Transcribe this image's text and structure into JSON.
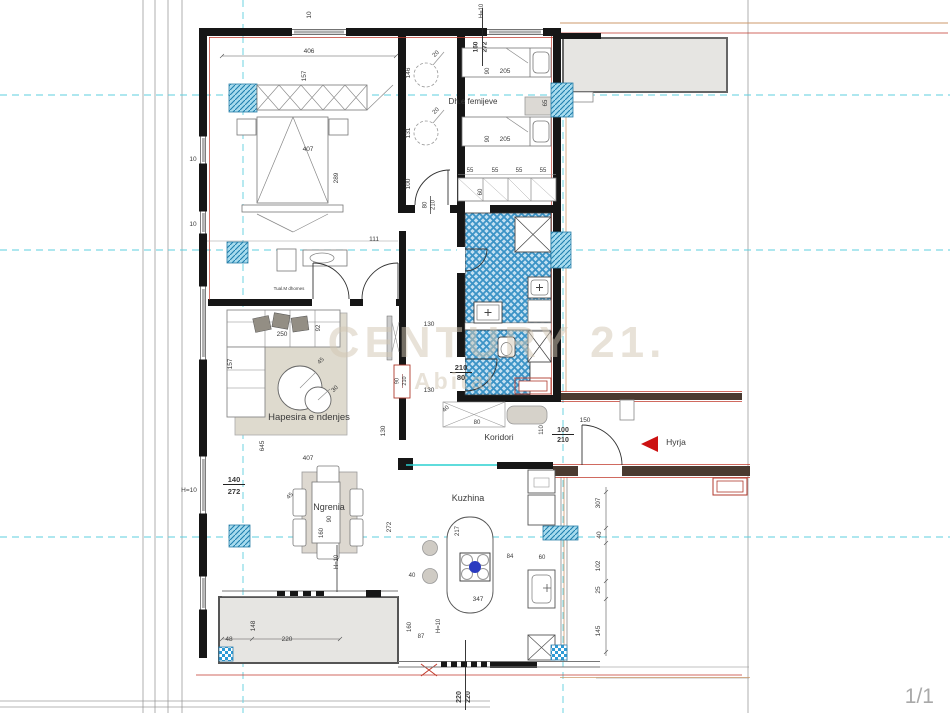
{
  "watermark": {
    "line1": "CENTURY 21.",
    "line2": "Abital"
  },
  "page": {
    "indicator": "1/1"
  },
  "colors": {
    "wall": "#161616",
    "accent_red": "#c0392b",
    "accent_orange": "#cd9a6b",
    "grid_cyan": "#5ecfdf",
    "tile_blue": "#3b93c6",
    "hatch_blue": "#1f7fae",
    "balcony_gray": "#e6e5e2",
    "watermark": "#d3c7b3"
  },
  "rooms": [
    {
      "t": "Dh.e femijeve",
      "x": 473,
      "y": 104,
      "s": 8
    },
    {
      "t": "Hapesira e ndenjes",
      "x": 309,
      "y": 420,
      "s": 9.5
    },
    {
      "t": "Ngrenia",
      "x": 329,
      "y": 510,
      "s": 9
    },
    {
      "t": "Kuzhina",
      "x": 468,
      "y": 501,
      "s": 9
    },
    {
      "t": "Koridori",
      "x": 499,
      "y": 440,
      "s": 8.5
    },
    {
      "t": "Hyrja",
      "x": 676,
      "y": 445,
      "s": 8.5
    },
    {
      "t": "Tual.M   dhomes",
      "x": 289,
      "y": 290,
      "s": 4.5
    }
  ],
  "annotations": [
    {
      "t": "10",
      "x": 311,
      "y": 15,
      "r": -90
    },
    {
      "t": "H=10",
      "x": 483,
      "y": 11,
      "r": -90,
      "c": "#c0392b",
      "s": 6
    },
    {
      "t": "160",
      "x": 477.5,
      "y": 47,
      "r": -90,
      "b": 1
    },
    {
      "t": "272",
      "x": 486.5,
      "y": 47,
      "r": -90,
      "b": 1
    },
    {
      "t": "10",
      "x": 193,
      "y": 161
    },
    {
      "t": "10",
      "x": 193,
      "y": 226
    },
    {
      "t": "H=10",
      "x": 189,
      "y": 492,
      "c": "#c0392b",
      "s": 6.5
    },
    {
      "t": "140",
      "x": 234,
      "y": 482,
      "b": 1,
      "s": 7.5
    },
    {
      "t": "272",
      "x": 234,
      "y": 494,
      "b": 1,
      "s": 7.5
    },
    {
      "t": "406",
      "x": 309,
      "y": 53
    },
    {
      "t": "157",
      "x": 306,
      "y": 76,
      "r": -90
    },
    {
      "t": "407",
      "x": 308,
      "y": 151
    },
    {
      "t": "289",
      "x": 338,
      "y": 178,
      "r": -90
    },
    {
      "t": "111",
      "x": 374,
      "y": 241
    },
    {
      "t": "146",
      "x": 410,
      "y": 73,
      "r": -90
    },
    {
      "t": "20",
      "x": 437,
      "y": 55,
      "r": -45,
      "s": 6
    },
    {
      "t": "131",
      "x": 410,
      "y": 133,
      "r": -90
    },
    {
      "t": "20",
      "x": 437,
      "y": 112,
      "r": -45,
      "s": 6
    },
    {
      "t": "100",
      "x": 410,
      "y": 184,
      "r": -90
    },
    {
      "t": "80",
      "x": 426.5,
      "y": 205,
      "r": -90,
      "s": 6
    },
    {
      "t": "210",
      "x": 434.5,
      "y": 205,
      "r": -90,
      "s": 6
    },
    {
      "t": "90",
      "x": 489,
      "y": 71,
      "r": -90,
      "s": 6
    },
    {
      "t": "205",
      "x": 505,
      "y": 73,
      "s": 6.5
    },
    {
      "t": "90",
      "x": 489,
      "y": 139,
      "r": -90,
      "s": 6
    },
    {
      "t": "205",
      "x": 505,
      "y": 141,
      "s": 6.5
    },
    {
      "t": "65",
      "x": 547,
      "y": 103,
      "r": -90,
      "s": 6
    },
    {
      "t": "55",
      "x": 470,
      "y": 172,
      "s": 6
    },
    {
      "t": "55",
      "x": 495,
      "y": 172,
      "s": 6
    },
    {
      "t": "55",
      "x": 519,
      "y": 172,
      "s": 6
    },
    {
      "t": "55",
      "x": 543,
      "y": 172,
      "s": 6
    },
    {
      "t": "60",
      "x": 482,
      "y": 192,
      "r": -90,
      "s": 6
    },
    {
      "t": "210",
      "x": 461,
      "y": 370,
      "b": 1,
      "s": 7.5
    },
    {
      "t": "80",
      "x": 461,
      "y": 380,
      "b": 1,
      "s": 7.5
    },
    {
      "t": "130",
      "x": 429,
      "y": 326
    },
    {
      "t": "130",
      "x": 429,
      "y": 392
    },
    {
      "t": "130",
      "x": 385,
      "y": 431,
      "r": -90
    },
    {
      "t": "40",
      "x": 447,
      "y": 410,
      "r": -45,
      "s": 6
    },
    {
      "t": "90",
      "x": 398.5,
      "y": 381,
      "r": -90,
      "s": 5.5,
      "c": "#8a4040"
    },
    {
      "t": "210",
      "x": 406,
      "y": 381,
      "r": -90,
      "s": 5.5,
      "c": "#8a4040"
    },
    {
      "t": "250",
      "x": 282,
      "y": 336
    },
    {
      "t": "92",
      "x": 320,
      "y": 328,
      "r": -90,
      "s": 6
    },
    {
      "t": "157",
      "x": 232,
      "y": 364,
      "r": -90
    },
    {
      "t": "45",
      "x": 322,
      "y": 362,
      "r": -45,
      "s": 6
    },
    {
      "t": "30",
      "x": 336,
      "y": 390,
      "r": -45,
      "s": 6
    },
    {
      "t": "645",
      "x": 264,
      "y": 446,
      "r": -90
    },
    {
      "t": "407",
      "x": 308,
      "y": 460
    },
    {
      "t": "45",
      "x": 291,
      "y": 497,
      "r": -45,
      "s": 6
    },
    {
      "t": "90",
      "x": 331,
      "y": 519,
      "r": -90,
      "s": 6
    },
    {
      "t": "160",
      "x": 323,
      "y": 533,
      "r": -90,
      "s": 6
    },
    {
      "t": "H=10",
      "x": 338,
      "y": 562,
      "r": -90,
      "c": "#c0392b",
      "s": 6
    },
    {
      "t": "272",
      "x": 391,
      "y": 527,
      "r": -90
    },
    {
      "t": "217",
      "x": 459,
      "y": 531,
      "r": -90,
      "s": 6
    },
    {
      "t": "347",
      "x": 478,
      "y": 601,
      "s": 6.5
    },
    {
      "t": "84",
      "x": 510,
      "y": 558,
      "s": 6
    },
    {
      "t": "60",
      "x": 542,
      "y": 559,
      "s": 6
    },
    {
      "t": "40",
      "x": 412,
      "y": 577,
      "s": 6
    },
    {
      "t": "160",
      "x": 411,
      "y": 627,
      "r": -90,
      "s": 6
    },
    {
      "t": "87",
      "x": 421,
      "y": 638,
      "s": 6
    },
    {
      "t": "307",
      "x": 600,
      "y": 503,
      "r": -90
    },
    {
      "t": "40",
      "x": 601,
      "y": 535,
      "r": -90
    },
    {
      "t": "102",
      "x": 600,
      "y": 566,
      "r": -90
    },
    {
      "t": "25",
      "x": 600,
      "y": 590,
      "r": -90
    },
    {
      "t": "145",
      "x": 600,
      "y": 631,
      "r": -90
    },
    {
      "t": "80",
      "x": 477,
      "y": 424,
      "s": 6
    },
    {
      "t": "110",
      "x": 543,
      "y": 430,
      "r": -90,
      "s": 6
    },
    {
      "t": "100",
      "x": 563,
      "y": 432,
      "b": 1,
      "s": 7
    },
    {
      "t": "210",
      "x": 563,
      "y": 442,
      "b": 1,
      "s": 7
    },
    {
      "t": "150",
      "x": 585,
      "y": 422,
      "s": 6.5
    },
    {
      "t": "48",
      "x": 229,
      "y": 641,
      "s": 6.5
    },
    {
      "t": "220",
      "x": 287,
      "y": 641,
      "s": 6.5
    },
    {
      "t": "148",
      "x": 255,
      "y": 626,
      "r": -90,
      "s": 6.5
    },
    {
      "t": "H=10",
      "x": 440,
      "y": 626,
      "r": -90,
      "c": "#c0392b",
      "s": 6
    },
    {
      "t": "220",
      "x": 461,
      "y": 697,
      "r": -90,
      "b": 1,
      "s": 7
    },
    {
      "t": "220",
      "x": 470,
      "y": 697,
      "r": -90,
      "b": 1,
      "s": 7
    }
  ]
}
